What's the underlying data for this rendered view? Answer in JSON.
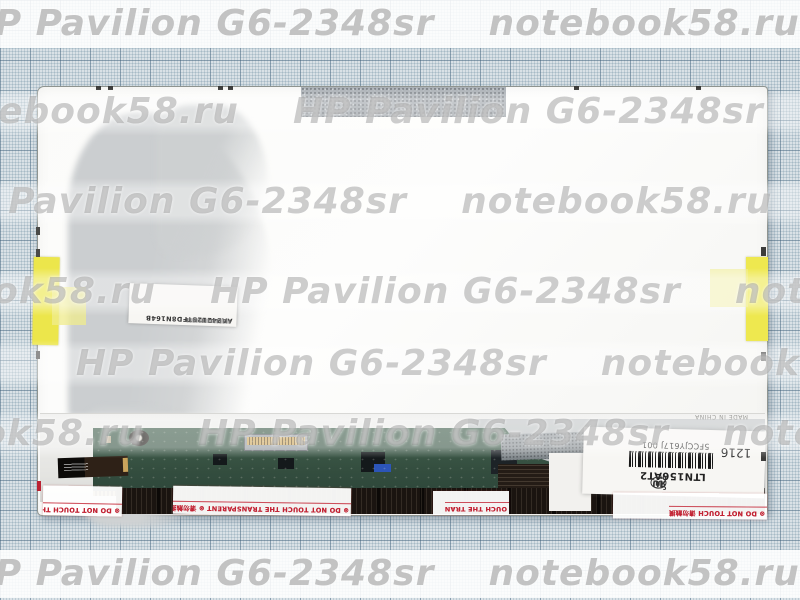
{
  "watermark": {
    "brand_a": "HP Pavilion G6-2348sr",
    "brand_b": "notebook58.ru",
    "rows": {
      "r1": "       P Pavilion G6-2348sr    notebook58.ru    HP Pav",
      "r2": "    otebook58.ru    HP Pavilion G6-2348sr    notebook5",
      "r3": "        Pavilion G6-2348sr    notebook58.ru    HP Pavi",
      "r4": "   book58.ru    HP Pavilion G6-2348sr    notebook58.ru",
      "r5": "             HP Pavilion G6-2348sr    notebook58.ru",
      "r6": "      ok58.ru    HP Pavilion G6-2348sr    notebook58",
      "r7": "       P Pavilion G6-2348sr    notebook58.ru    HP Pav"
    }
  },
  "panel": {
    "barcode_label": {
      "code": "AA24212STFD8N164B"
    },
    "main_label": {
      "model": "LTN156AT2",
      "part_number": "5FCCJY617J 001",
      "date_code": "1216",
      "ul_prefix": "c",
      "ul": "UL",
      "ul_suffix": "us",
      "ru_mark": "ЯU"
    },
    "made_in": "MADE IN CHINA",
    "pcb_silkscreen": "LTN156AT02L/V0 2.1N",
    "warnings": {
      "left": "⊗ DO NOT TOUCH THE",
      "main": "⊗ DO NOT TOUCH THE TRANSPARENT ⊗ 请勿触摸",
      "fragment": "OUCH THE TRAN",
      "right": "⊗ DO NOT TOUCH 请勿触摸"
    }
  },
  "colors": {
    "grid_line": "#3e607a",
    "tape_yellow": "#eee84f",
    "pcb_green": "#344e3f",
    "warning_red": "#c22233",
    "panel_white": "#fbfbf9"
  }
}
